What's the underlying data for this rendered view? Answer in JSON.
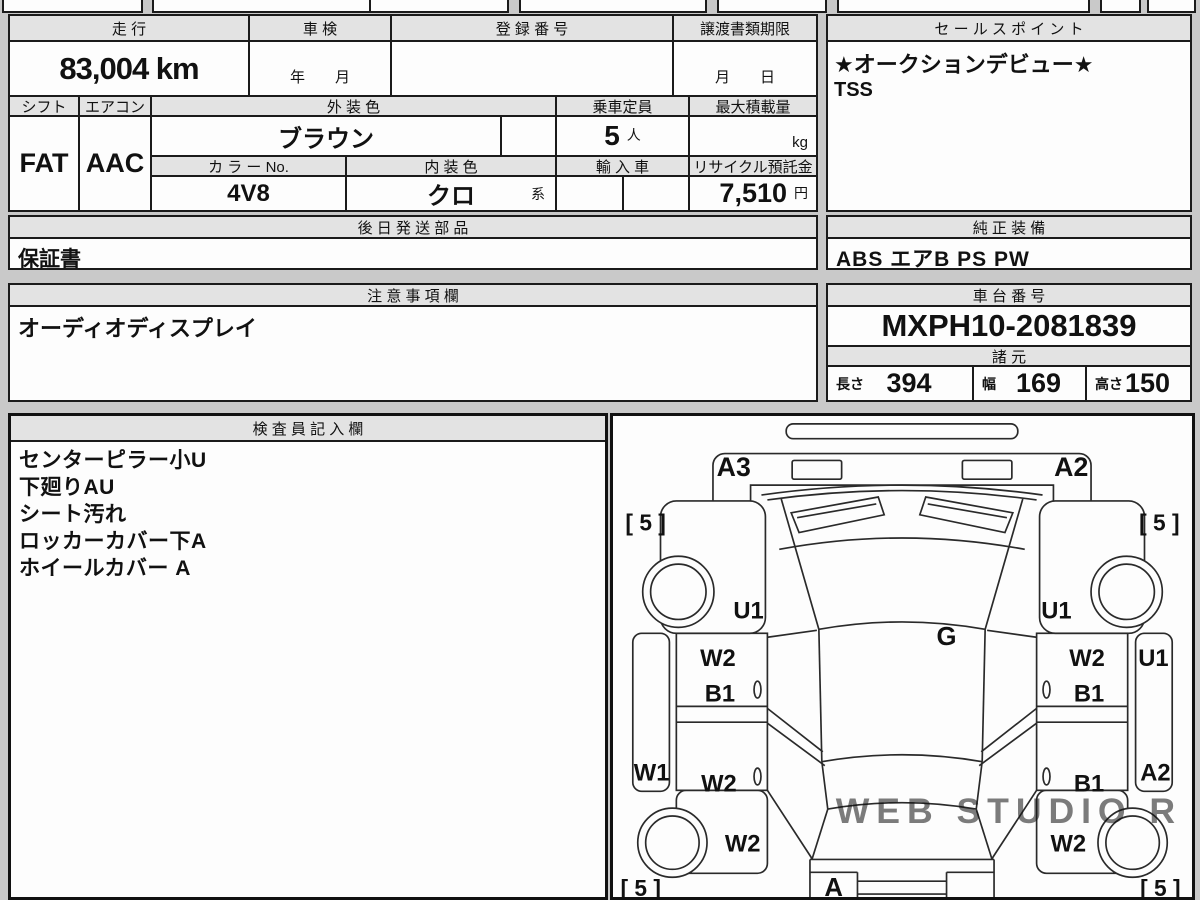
{
  "top_table": {
    "mileage_header": "走 行",
    "mileage_value": "83,004 km",
    "inspection_header": "車 検",
    "inspection_value": "年　　月",
    "registration_header": "登 録 番 号",
    "registration_value": "",
    "transfer_deadline_header": "譲渡書類期限",
    "transfer_deadline_value": "月　　日",
    "shift_header": "シフト",
    "shift_value": "FAT",
    "aircon_header": "エアコン",
    "aircon_value": "AAC",
    "exterior_color_header": "外 装 色",
    "exterior_color_value": "ブラウン",
    "capacity_header": "乗車定員",
    "capacity_value": "5",
    "capacity_unit": "人",
    "max_load_header": "最大積載量",
    "max_load_unit": "kg",
    "color_no_header": "カ ラ ー No.",
    "color_no_value": "4V8",
    "interior_color_header": "内 装 色",
    "interior_color_value": "クロ",
    "interior_color_suffix": "系",
    "import_header": "輸 入 車",
    "recycle_header": "リサイクル預託金",
    "recycle_value": "7,510",
    "recycle_unit": "円"
  },
  "sales_point": {
    "header": "セ ー ル ス ポ イ ン ト",
    "line1": "★オークションデビュー★",
    "line2": "TSS"
  },
  "later_parts": {
    "header": "後 日 発 送 部 品",
    "value": "保証書"
  },
  "genuine_equipment": {
    "header": "純 正 装 備",
    "value": "ABS エアB PS PW"
  },
  "notes": {
    "header": "注 意 事 項 欄",
    "value": "オーディオディスプレイ"
  },
  "chassis": {
    "header": "車 台 番 号",
    "value": "MXPH10-2081839"
  },
  "specs": {
    "header": "諸 元",
    "length_label": "長さ",
    "length_value": "394",
    "width_label": "幅",
    "width_value": "169",
    "height_label": "高さ",
    "height_value": "150"
  },
  "inspector": {
    "header": "検 査 員 記 入 欄",
    "items": [
      "センターピラー小U",
      "下廻りAU",
      "シート汚れ",
      "ロッカーカバー下A",
      "ホイールカバー A"
    ]
  },
  "diagram": {
    "watermark": "WEB STUDIO R",
    "labels": [
      {
        "name": "code-a3-front-bumper",
        "text": "A3",
        "x": 122,
        "y": 61,
        "size": 27
      },
      {
        "name": "code-a2-front-bumper",
        "text": "A2",
        "x": 463,
        "y": 61,
        "size": 27
      },
      {
        "name": "tread-front-left",
        "text": "[ 5 ]",
        "x": 33,
        "y": 116,
        "size": 23
      },
      {
        "name": "tread-front-right",
        "text": "[ 5 ]",
        "x": 552,
        "y": 116,
        "size": 23
      },
      {
        "name": "code-u1-front-left-fender",
        "text": "U1",
        "x": 137,
        "y": 205,
        "size": 24
      },
      {
        "name": "code-u1-front-right-fender",
        "text": "U1",
        "x": 448,
        "y": 205,
        "size": 24
      },
      {
        "name": "code-g-windshield",
        "text": "G",
        "x": 337,
        "y": 232,
        "size": 26
      },
      {
        "name": "code-w2-left-front-door",
        "text": "W2",
        "x": 106,
        "y": 253,
        "size": 24
      },
      {
        "name": "code-b1-left-front-door",
        "text": "B1",
        "x": 108,
        "y": 289,
        "size": 24
      },
      {
        "name": "code-w2-right-front-door",
        "text": "W2",
        "x": 479,
        "y": 253,
        "size": 24
      },
      {
        "name": "code-b1-right-front-door",
        "text": "B1",
        "x": 481,
        "y": 289,
        "size": 24
      },
      {
        "name": "code-w1-left-rocker",
        "text": "W1",
        "x": 39,
        "y": 369,
        "size": 24
      },
      {
        "name": "code-w2-left-rear-door",
        "text": "W2",
        "x": 107,
        "y": 380,
        "size": 24
      },
      {
        "name": "code-b1-right-rear-door",
        "text": "B1",
        "x": 481,
        "y": 380,
        "size": 24
      },
      {
        "name": "code-u1-right-rocker",
        "text": "U1",
        "x": 546,
        "y": 253,
        "size": 24
      },
      {
        "name": "code-a2-right-rear",
        "text": "A2",
        "x": 548,
        "y": 369,
        "size": 24
      },
      {
        "name": "code-w2-left-rear-fender",
        "text": "W2",
        "x": 131,
        "y": 441,
        "size": 24
      },
      {
        "name": "code-w2-right-rear-fender",
        "text": "W2",
        "x": 460,
        "y": 441,
        "size": 24
      },
      {
        "name": "tread-rear-left",
        "text": "[ 5 ]",
        "x": 28,
        "y": 486,
        "size": 23
      },
      {
        "name": "tread-rear-right",
        "text": "[ 5 ]",
        "x": 553,
        "y": 486,
        "size": 23
      },
      {
        "name": "code-a-rear-bumper",
        "text": "A",
        "x": 223,
        "y": 486,
        "size": 26
      }
    ]
  }
}
